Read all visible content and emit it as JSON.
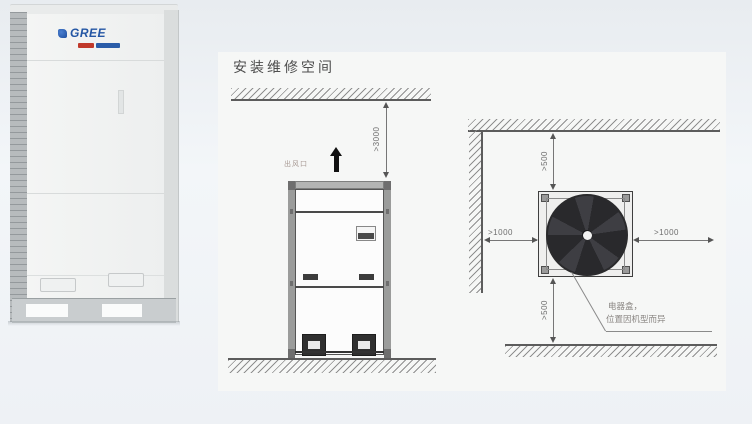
{
  "brand": {
    "name": "GREE"
  },
  "panel": {
    "title": "安装维修空间"
  },
  "side_view": {
    "ceiling_clearance": ">3000",
    "air_outlet_label": "出风口"
  },
  "top_view": {
    "top_clearance": ">500",
    "bottom_clearance": ">500",
    "left_clearance": ">1000",
    "right_clearance": ">1000",
    "callout_line1": "电器盒，",
    "callout_line2": "位置因机型而异"
  },
  "colors": {
    "panel_bg": "#f6f7f6",
    "diagram_line": "#5c5c5c",
    "brand_blue": "#2456a4",
    "fan_dark": "#2a2a2d"
  }
}
